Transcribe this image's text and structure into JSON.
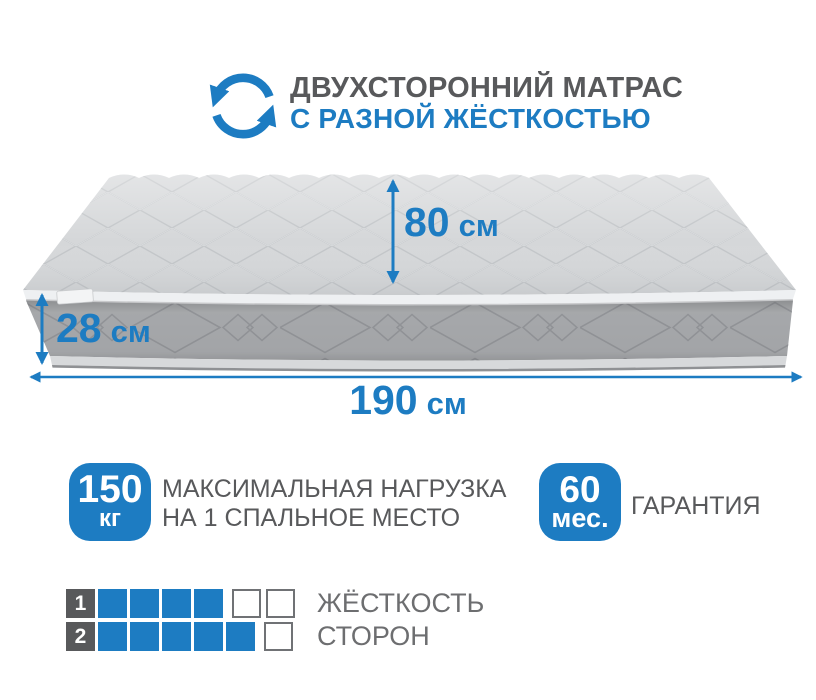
{
  "colors": {
    "accent_blue": "#1d7cc2",
    "title_dark": "#58595b",
    "caption_gray": "#6d6e70",
    "mattress_top": "#d5d7d9",
    "mattress_side": "#a9abae"
  },
  "header": {
    "icon": "rotate-arrows-icon",
    "title_line1": "ДВУХСТОРОННИЙ МАТРАС",
    "title_line2": "С РАЗНОЙ ЖЁСТКОСТЬЮ"
  },
  "dimensions": {
    "width": {
      "value": "80",
      "unit": "см"
    },
    "height": {
      "value": "28",
      "unit": "см"
    },
    "length": {
      "value": "190",
      "unit": "см"
    }
  },
  "badges": [
    {
      "value": "150",
      "unit": "кг",
      "line1": "МАКСИМАЛЬНАЯ НАГРУЗКА",
      "line2": "НА 1 СПАЛЬНОЕ МЕСТО"
    },
    {
      "value": "60",
      "unit": "мес.",
      "line1": "ГАРАНТИЯ"
    }
  ],
  "firmness": {
    "rows": [
      {
        "side": "1",
        "filled": 4,
        "total": 6,
        "label": "ЖЁСТКОСТЬ"
      },
      {
        "side": "2",
        "filled": 5,
        "total": 6,
        "label": "СТОРОН"
      }
    ]
  }
}
